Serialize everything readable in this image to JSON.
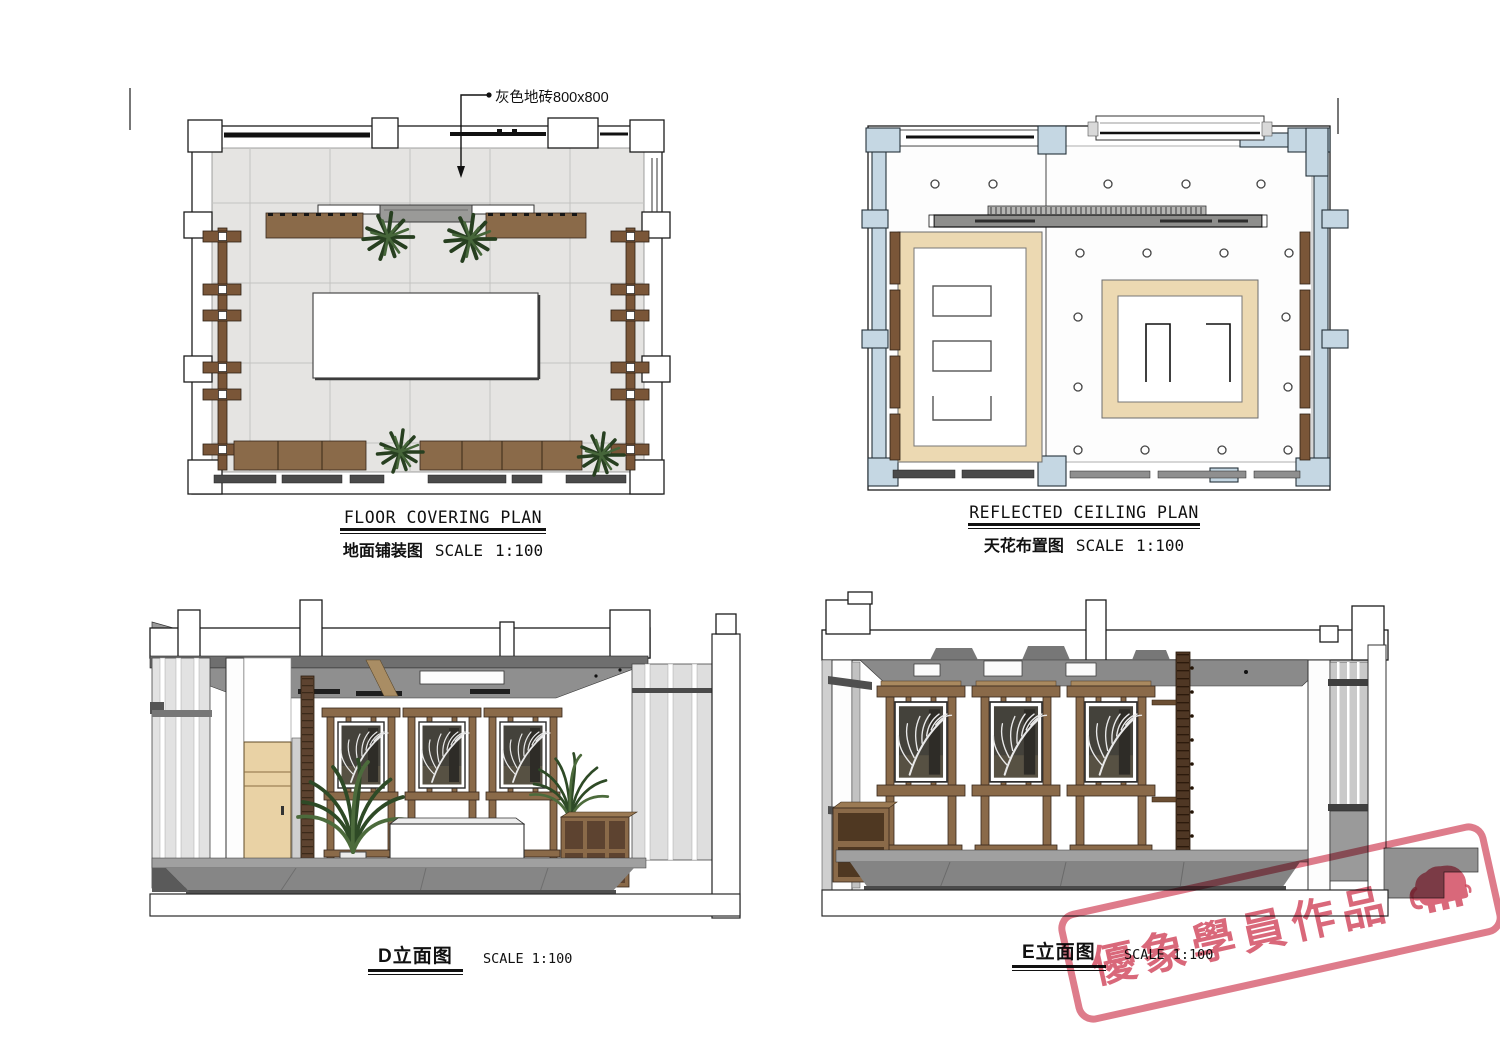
{
  "floor_plan": {
    "title_en": "FLOOR COVERING PLAN",
    "title_zh": "地面铺装图",
    "scale_label": "SCALE",
    "scale_value": "1:100",
    "annotation_tile": "灰色地砖800x800"
  },
  "ceiling_plan": {
    "title_en": "REFLECTED CEILING PLAN",
    "title_zh": "天花布置图",
    "scale_label": "SCALE",
    "scale_value": "1:100"
  },
  "elevation_d": {
    "title": "D立面图",
    "scale_label": "SCALE",
    "scale_value": "1:100"
  },
  "elevation_e": {
    "title": "E立面图",
    "scale_label": "SCALE",
    "scale_value": "1:100"
  },
  "watermark": {
    "text": "優象學員作品",
    "icon": "elephant-icon",
    "color": "#ce3e54"
  },
  "colors": {
    "floor_tile": "#e5e4e2",
    "wood": "#8a6a49",
    "dark_wood": "#4f3724",
    "ceiling_column_blue": "#c5d7e3",
    "ceiling_wood_frame": "#ecd9b2",
    "beam_gray": "#8e8e8c",
    "stamp_red": "#ce3e54"
  }
}
